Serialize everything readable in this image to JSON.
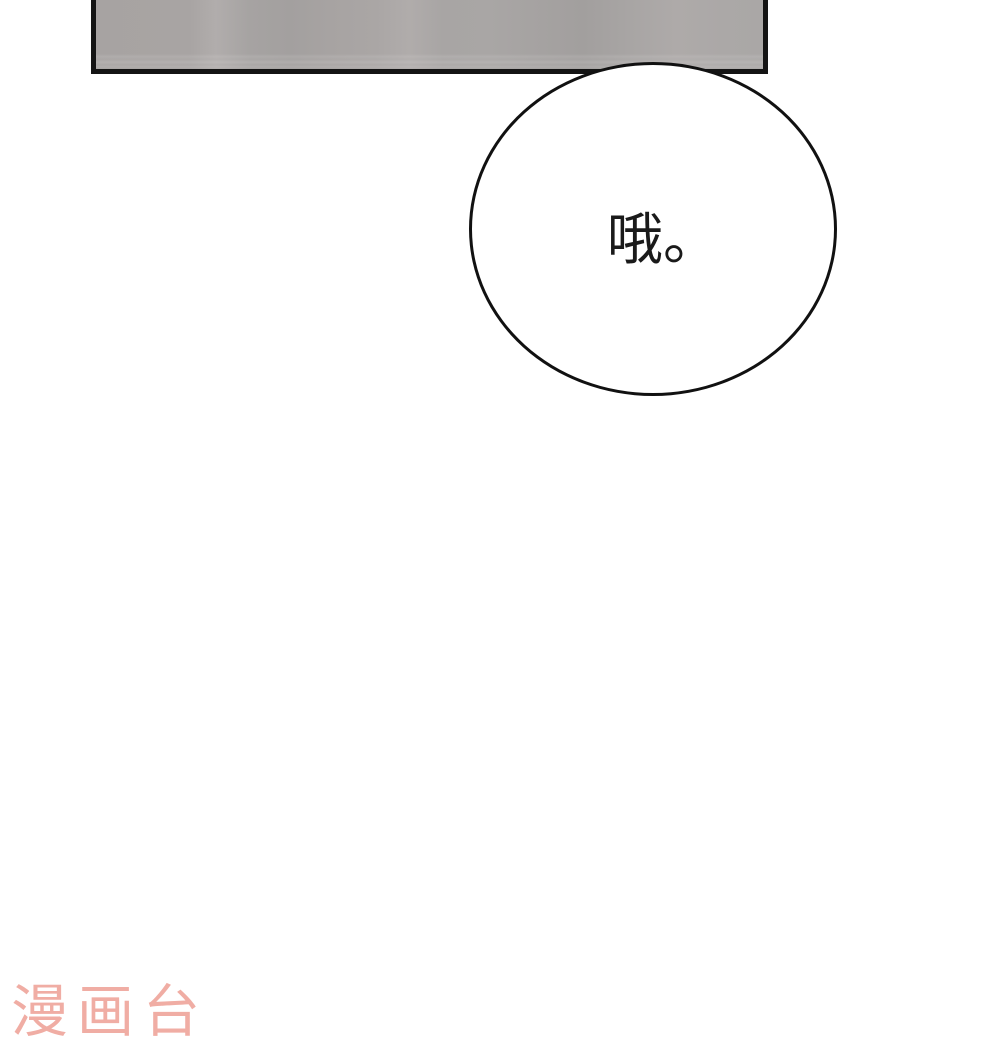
{
  "page": {
    "background_color": "#ffffff",
    "width_px": 1000,
    "height_px": 1053
  },
  "panel": {
    "description": "partial grey comic panel cropped at top of page",
    "fill_color": "#a8a4a3",
    "border_color": "#141414"
  },
  "speech_bubble": {
    "text": "哦。",
    "text_color": "#1a1a1a",
    "fill_color": "#ffffff",
    "stroke_color": "#111111"
  },
  "watermark": {
    "text": "漫画台",
    "color": "#f0ada4"
  }
}
